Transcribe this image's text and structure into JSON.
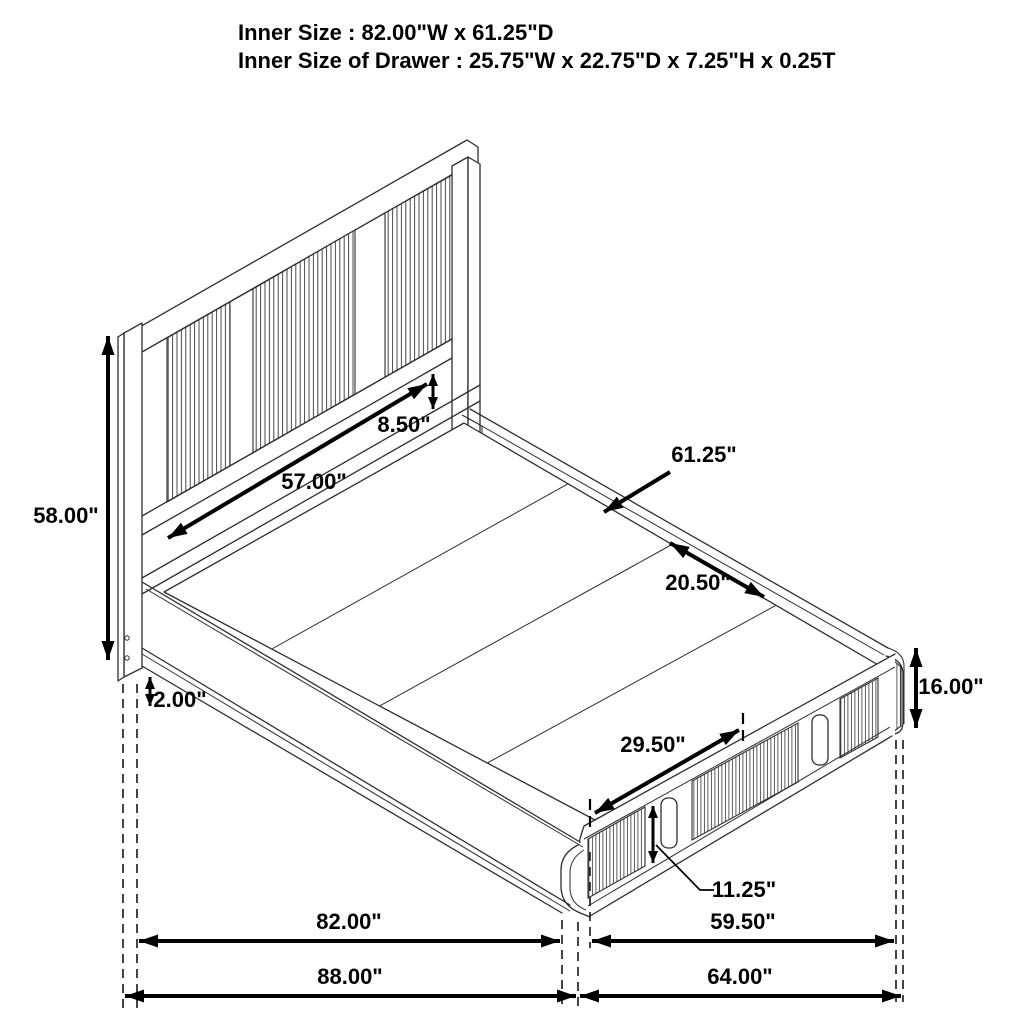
{
  "header": {
    "line1": "Inner Size : 82.00\"W x 61.25\"D",
    "line2": "Inner Size of Drawer : 25.75\"W x 22.75\"D x 7.25\"H x 0.25T"
  },
  "dimensions": {
    "headboard_height": "58.00\"",
    "headboard_opening_width": "57.00\"",
    "headboard_opening_height": "8.50\"",
    "inner_depth": "61.25\"",
    "deck_panel_spacing": "20.50\"",
    "base_height": "16.00\"",
    "drawer_opening_width": "29.50\"",
    "drawer_front_height": "11.25\"",
    "floor_clearance": "2.00\"",
    "inner_length": "82.00\"",
    "overall_length": "88.00\"",
    "foot_inner_width": "59.50\"",
    "overall_width": "64.00\""
  },
  "colors": {
    "line": "#2e2e2e",
    "dimension": "#000000",
    "background": "#ffffff"
  }
}
